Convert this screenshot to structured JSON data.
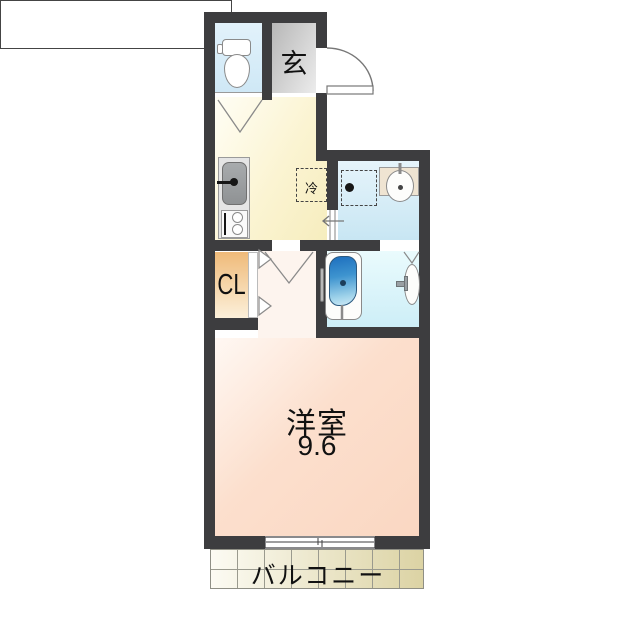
{
  "type": "japanese-apartment-floor-plan",
  "labels": {
    "entrance": "玄",
    "refrigerator": "冷",
    "closet": "CL",
    "main_room_name": "洋室",
    "main_room_size": "9.6",
    "balcony": "バルコニー"
  },
  "rooms": [
    {
      "name": "toilet-room"
    },
    {
      "name": "entrance",
      "label": "玄"
    },
    {
      "name": "kitchen"
    },
    {
      "name": "washroom"
    },
    {
      "name": "bathroom"
    },
    {
      "name": "closet",
      "label": "CL"
    },
    {
      "name": "western-room",
      "label": "洋室",
      "size_tatami": "9.6"
    },
    {
      "name": "balcony",
      "label": "バルコニー"
    }
  ],
  "colors": {
    "wall": "#3d3d3f",
    "toilet_room": "#d9edf8",
    "entrance": "#d9d9d9",
    "kitchen": "#f9f1c8",
    "washroom": "#cfe9f5",
    "bathroom": "#d5f1f9",
    "closet": "#f2c489",
    "main_room": "#fbdac6",
    "balcony": "#e7dfba",
    "bathtub": "#2d7fc4"
  }
}
